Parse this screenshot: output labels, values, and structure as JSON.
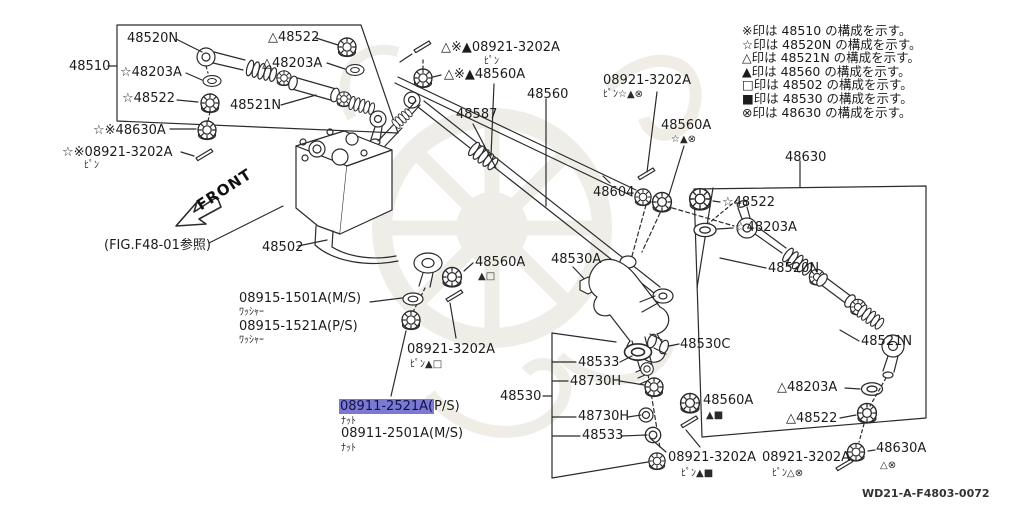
{
  "legend": {
    "items": [
      {
        "text": "※印は 48510 の構成を示す。"
      },
      {
        "text": "☆印は 48520N の構成を示す。"
      },
      {
        "text": "△印は 48521N の構成を示す。"
      },
      {
        "text": "▲印は 48560 の構成を示す。"
      },
      {
        "text": "□印は 48502 の構成を示す。"
      },
      {
        "text": "■印は 48530 の構成を示す。"
      },
      {
        "text": "⊗印は 48630 の構成を示す。"
      }
    ]
  },
  "labels": {
    "b1_48520n": "48520N",
    "b1_48510": "48510",
    "b1_48203a": "☆48203A",
    "b1_48522": "☆48522",
    "b1_48522_t": "△48522",
    "b1_48203a_t": "△48203A",
    "b1_48521n": "48521N",
    "l_48630a": "☆※48630A",
    "l_08921": "☆※08921-3202A",
    "l_08921_sub": "ﾋﾟﾝ",
    "t_08921": "△※▲08921-3202A",
    "t_08921_sub": "ﾋﾟﾝ",
    "t_48560a": "△※▲48560A",
    "t_48560": "48560",
    "t_48587": "48587",
    "rt_08921": "08921-3202A",
    "rt_08921_sub": "ﾋﾟﾝ☆▲⊗",
    "rt_48560a": "48560A",
    "rt_48560a_sub": "☆▲⊗",
    "t_48604": "48604",
    "r_48630": "48630",
    "b2_48522_s": "☆48522",
    "b2_48203a_s": "☆48203A",
    "b2_48520n": "48520N",
    "b2_48521n": "48521N",
    "b2_48203a_t": "△48203A",
    "b2_48522_t": "△48522",
    "r_48630a": "48630A",
    "r_48630a_sub": "△⊗",
    "fig_ref": "(FIG.F48-01参照)",
    "c_48502": "48502",
    "w_ms": "08915-1501A(M/S)",
    "w_ms_sub": "ﾜｯｼｬｰ",
    "w_ps": "08915-1521A(P/S)",
    "w_ps_sub": "ﾜｯｼｬｰ",
    "m_48560a": "48560A",
    "m_48560a_sub": "▲□",
    "m_08921": "08921-3202A",
    "m_08921_sub": "ﾋﾟﾝ▲□",
    "hl_main": "08911-2521A(",
    "hl_rest": "P/S)",
    "hl_sub": "ﾅｯﾄ",
    "n_ms": "08911-2501A(M/S)",
    "n_ms_sub": "ﾅｯﾄ",
    "c_48530a": "48530A",
    "c_48530c": "48530C",
    "s_48533_1": "48533",
    "s_48730h_1": "48730H",
    "s_48530": "48530",
    "s_48730h_2": "48730H",
    "s_48533_2": "48533",
    "b_48560a": "48560A",
    "b_48560a_sub": "▲■",
    "b_08921_1": "08921-3202A",
    "b_08921_1_sub": "ﾋﾟﾝ▲■",
    "b_08921_2": "08921-3202A",
    "b_08921_2_sub": "ﾋﾟﾝ△⊗",
    "front": "FRONT",
    "dwg_no": "WD21-A-F4803-0072"
  },
  "colors": {
    "highlight": "#7b79d2",
    "line": "#2b2b2b",
    "watermark": "#edeae3"
  }
}
